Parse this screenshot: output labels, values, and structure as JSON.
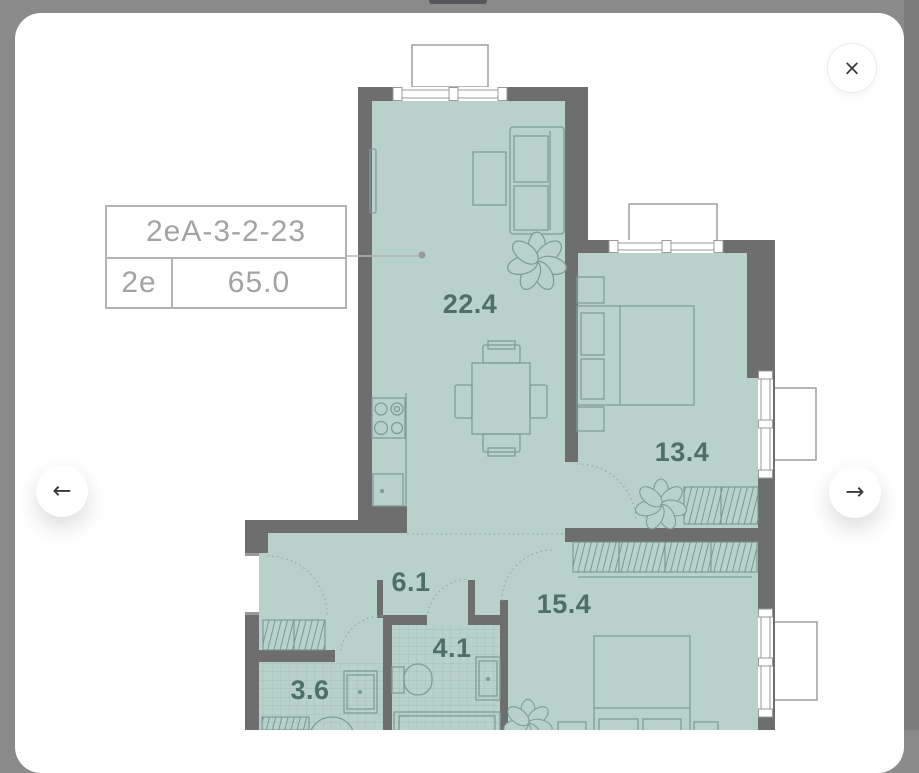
{
  "modal": {
    "close_icon": "×",
    "prev_icon": "←",
    "next_icon": "→"
  },
  "unit_card": {
    "unit_id": "2eA-3-2-23",
    "unit_type": "2e",
    "total_area": "65.0"
  },
  "floor_plan": {
    "rooms": [
      {
        "name": "living-kitchen",
        "area": "22.4"
      },
      {
        "name": "bedroom-1",
        "area": "13.4"
      },
      {
        "name": "hallway",
        "area": "6.1"
      },
      {
        "name": "bedroom-2",
        "area": "15.4"
      },
      {
        "name": "bathroom",
        "area": "4.1"
      },
      {
        "name": "wc",
        "area": "3.6"
      }
    ]
  },
  "colors": {
    "backdrop": "#8a8a8a",
    "room_fill": "#b9d1cb",
    "wall": "#6e6e6e",
    "furniture_line": "#7c9d96",
    "room_label": "#4d6f66",
    "card_text": "#a3a3a3",
    "card_border": "#b3b3b3"
  }
}
